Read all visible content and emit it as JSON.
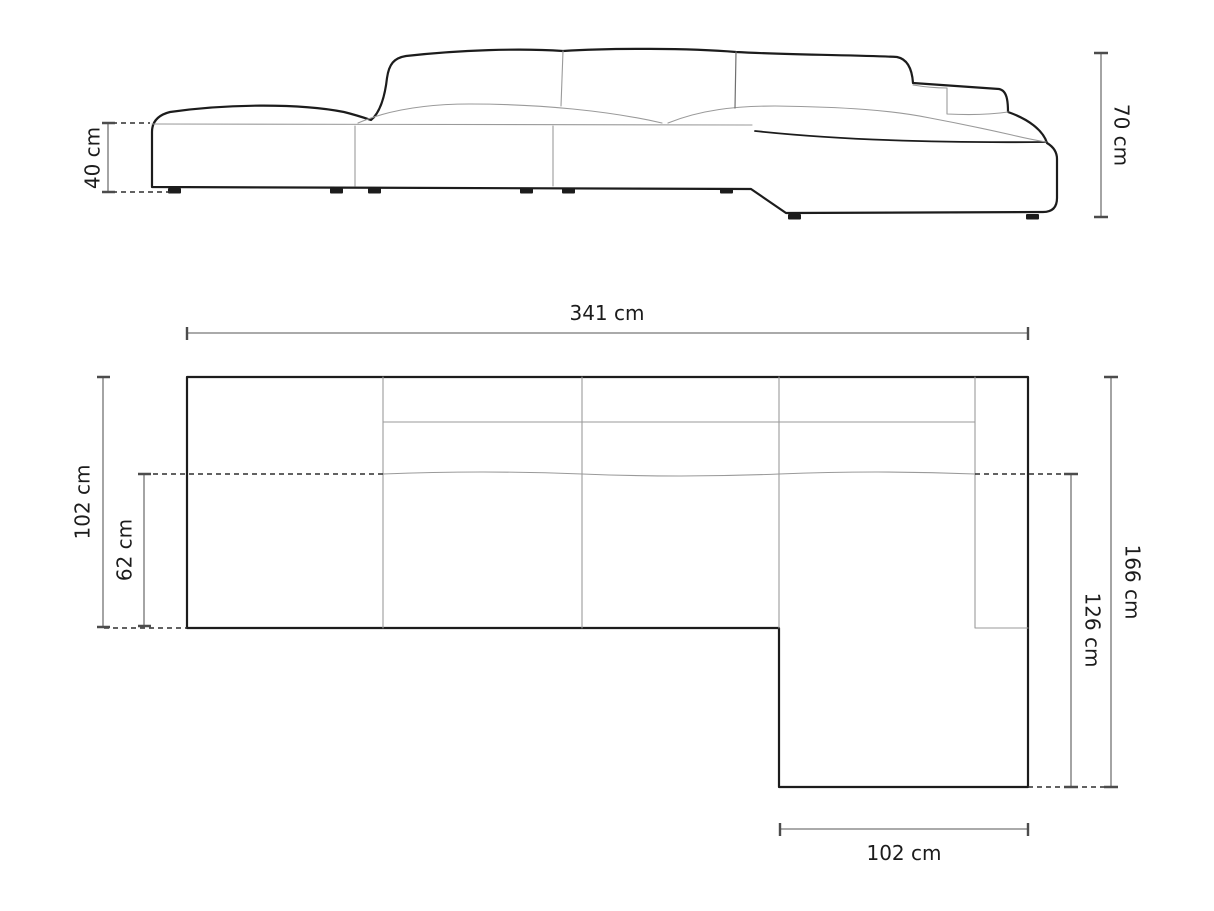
{
  "page": {
    "background": "#ffffff",
    "description": "Technical dimension drawing of a modular corner sofa with right-hand chaise: side elevation view above, top plan view below"
  },
  "colors": {
    "sofa_outline": "#1c1c1c",
    "seam_line": "#9a9a9a",
    "dimension_line": "#8d8d8d",
    "dimension_tick": "#4c4c4c",
    "dashed_line": "#2e2e2e",
    "label_text": "#1c1c1c"
  },
  "side_view": {
    "seat_height": "40 cm",
    "total_height": "70 cm"
  },
  "top_view": {
    "total_width": "341 cm",
    "total_depth": "102 cm",
    "seat_depth": "62 cm",
    "chaise_depth_inner": "126 cm",
    "chaise_depth_outer": "166 cm",
    "chaise_width": "102 cm"
  }
}
